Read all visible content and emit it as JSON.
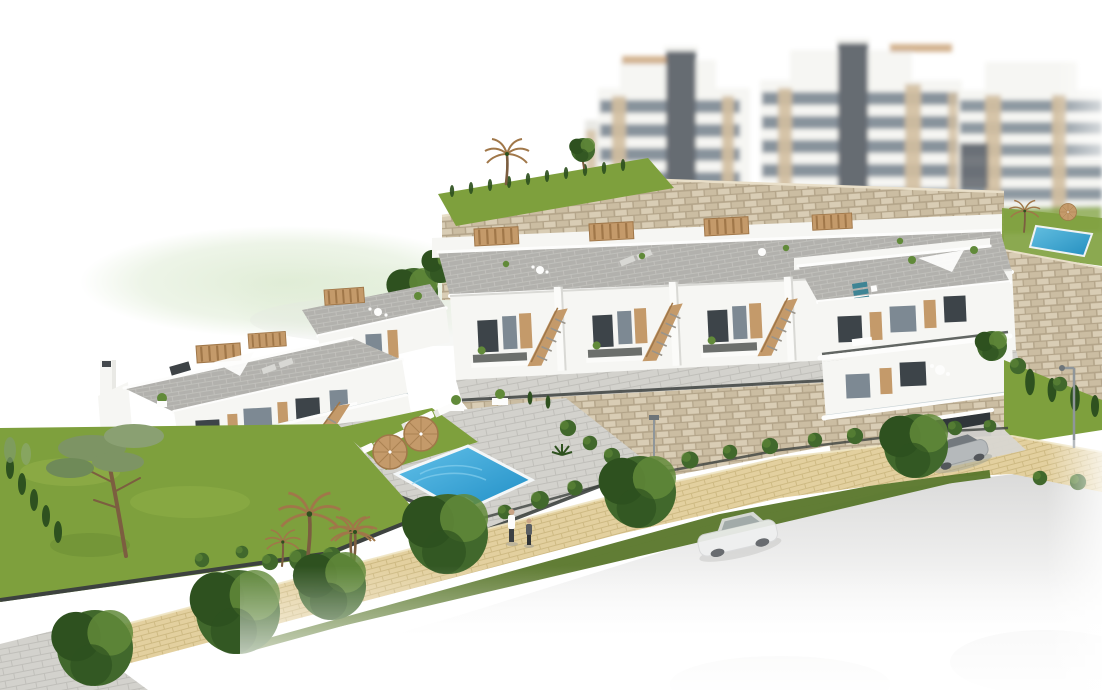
{
  "scene": {
    "title": "Aerial 3D architectural rendering of a hillside residential development with terraced townhouses, a communal swimming pool, landscaped gardens, a pedestrian path and apartment blocks behind a stone retaining wall",
    "objects": {
      "background_apartment_blocks": 3,
      "townhouse_rows": 2,
      "communal_pool": 1,
      "background_pool": 1,
      "parasols": 2,
      "sun_loungers": 7,
      "rooftop_pergolas": 7,
      "pedestrians": 2,
      "cars": 2,
      "car_types": [
        "white-sedan-on-road",
        "silver-coupe-at-garage"
      ],
      "street_lamps": 2,
      "palm_trees": 5,
      "garage_doors": 1
    }
  },
  "colors": {
    "bldg_white": "#f6f6f3",
    "bldg_shade": "#e9e9e5",
    "bldg_tan": "#d3bfa0",
    "win_dark": "#3d4449",
    "win_glass": "#7d8993",
    "tower_dark": "#666c72",
    "wood": "#c49a6a",
    "wood_dark": "#a07749",
    "roof": "#b2b1ad",
    "roof_light": "#c8c7c3",
    "stone_light": "#d9cdb5",
    "stone_mid": "#cbbda2",
    "stone_dark": "#b3a489",
    "grass": "#7ea03d",
    "grass_dark": "#59772b",
    "grass_light": "#a4bf55",
    "tree": "#41682c",
    "tree_dark": "#2e511f",
    "tree_light": "#618a39",
    "sand": "#e3d09f",
    "sand_line": "#c9b47c",
    "deck": "#d3d2cd",
    "deck_line": "#bebdb8",
    "pool_light": "#63c1e9",
    "pool_deep": "#1e8dc5",
    "road": "#d9d9d8",
    "fence_dark": "#3d423f",
    "teal": "#3e8494",
    "hill": "#dfecd5",
    "skin": "#c9a486",
    "car_silver": "#b5b9bb",
    "trunk": "#7c5e40"
  }
}
